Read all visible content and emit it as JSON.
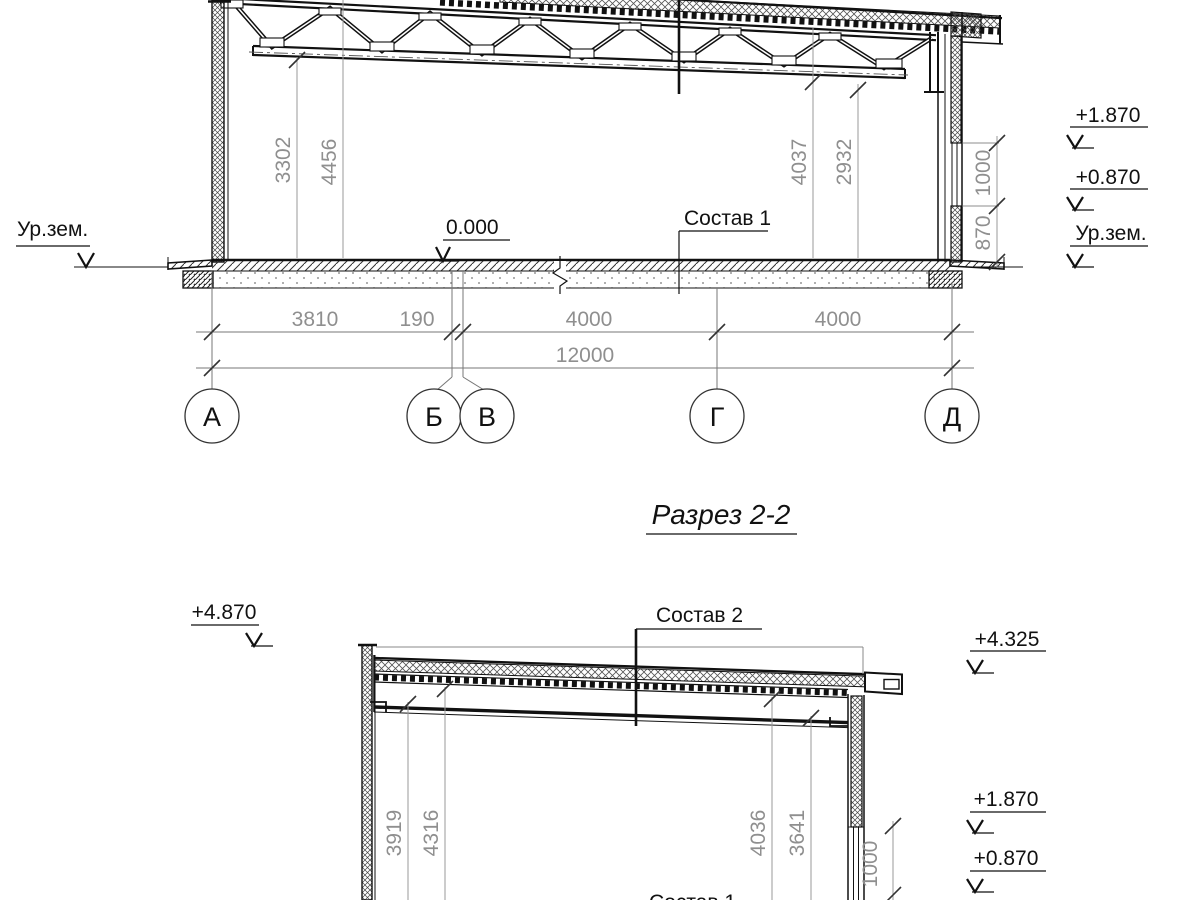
{
  "title": {
    "text": "Разрез 2-2"
  },
  "section1": {
    "ground_left": "Ур.зем.",
    "zero_mark": "0.000",
    "floor_label": "Состав 1",
    "levels_right": [
      {
        "v": "+1.870"
      },
      {
        "v": "+0.870"
      },
      {
        "v": "Ур.зем."
      }
    ],
    "wall_dims": {
      "upper": "1000",
      "lower": "870"
    },
    "height_dims": [
      {
        "v": "3302"
      },
      {
        "v": "4456"
      },
      {
        "v": "4037"
      },
      {
        "v": "2932"
      }
    ],
    "span_dims": [
      {
        "v": "3810"
      },
      {
        "v": "190"
      },
      {
        "v": "4000"
      },
      {
        "v": "4000"
      }
    ],
    "total_dim": "12000",
    "axes": [
      {
        "label": "А"
      },
      {
        "label": "Б"
      },
      {
        "label": "В"
      },
      {
        "label": "Г"
      },
      {
        "label": "Д"
      }
    ]
  },
  "section2": {
    "level_left": "+4.870",
    "roof_label": "Состав 2",
    "levels_right": [
      {
        "v": "+4.325"
      },
      {
        "v": "+1.870"
      },
      {
        "v": "+0.870"
      }
    ],
    "height_dims": [
      {
        "v": "3919"
      },
      {
        "v": "4316"
      },
      {
        "v": "4036"
      },
      {
        "v": "3641"
      }
    ],
    "wall_dim": "1000",
    "floor_label_partial": "Состав 1"
  }
}
